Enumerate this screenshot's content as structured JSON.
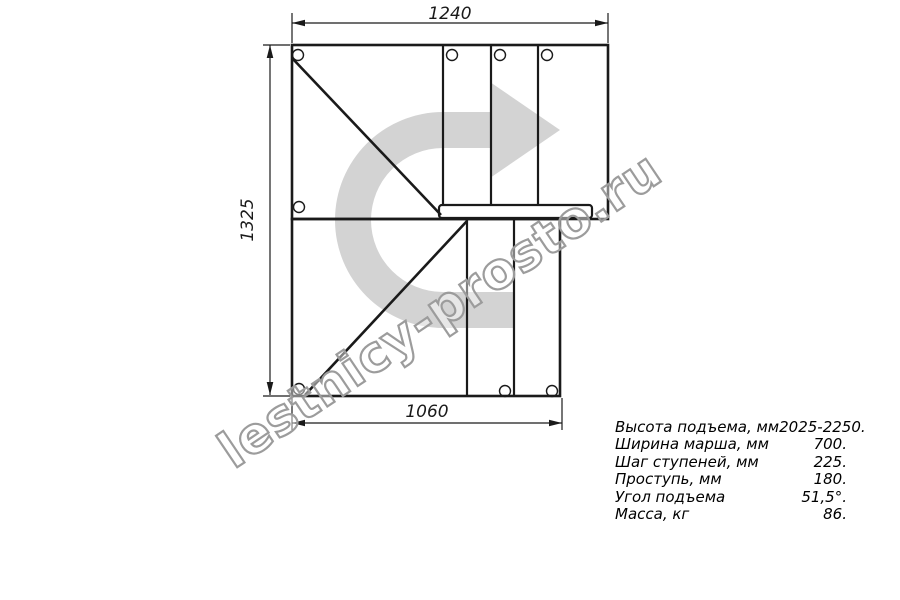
{
  "dimensions": {
    "top": "1240",
    "left": "1325",
    "bottom": "1060"
  },
  "specs": {
    "rows": [
      {
        "label": "Высота подъема, мм",
        "value": "2025-2250."
      },
      {
        "label": "Ширина марша, мм",
        "value": "700."
      },
      {
        "label": "Шаг ступеней, мм",
        "value": "225."
      },
      {
        "label": "Проступь, мм",
        "value": "180."
      },
      {
        "label": "Угол подъема",
        "value": "51,5°."
      },
      {
        "label": "Масса, кг",
        "value": "86."
      }
    ]
  },
  "watermark": {
    "text": "lestnicy-prosto.ru"
  },
  "colors": {
    "line": "#1a1a1a",
    "turn_arrow_fill": "#d3d3d3",
    "watermark_outline": "#9c9c9c",
    "background": "#ffffff"
  }
}
